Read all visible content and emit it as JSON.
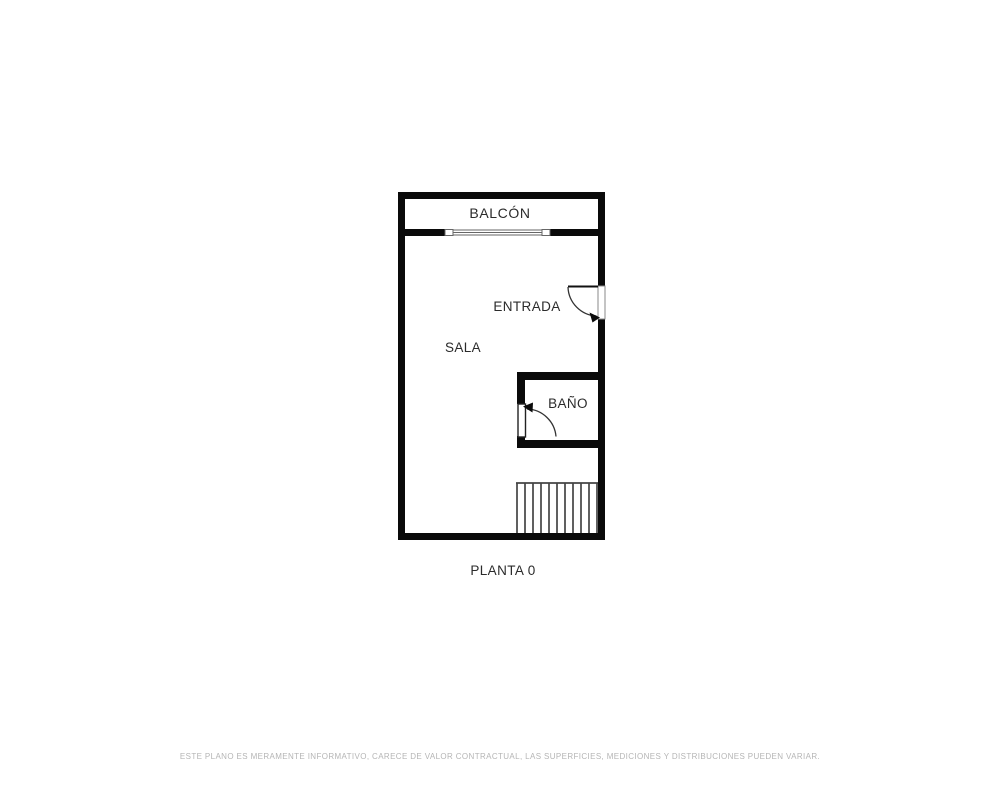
{
  "floor_plan": {
    "labels": {
      "balcony": "BALCÓN",
      "entrance": "ENTRADA",
      "living_room": "SALA",
      "bathroom": "BAÑO"
    },
    "floor_label": "PLANTA 0",
    "colors": {
      "wall": "#0a0a0a",
      "label_text": "#2b2b2b",
      "window_outline": "#666666",
      "door_arc": "#333333",
      "stairs_line": "#444444",
      "disclaimer_text": "#b5b5b5",
      "background": "#ffffff"
    }
  },
  "footer": {
    "disclaimer": "ESTE PLANO ES MERAMENTE INFORMATIVO, CARECE DE VALOR CONTRACTUAL, LAS SUPERFICIES, MEDICIONES Y DISTRIBUCIONES PUEDEN VARIAR."
  }
}
